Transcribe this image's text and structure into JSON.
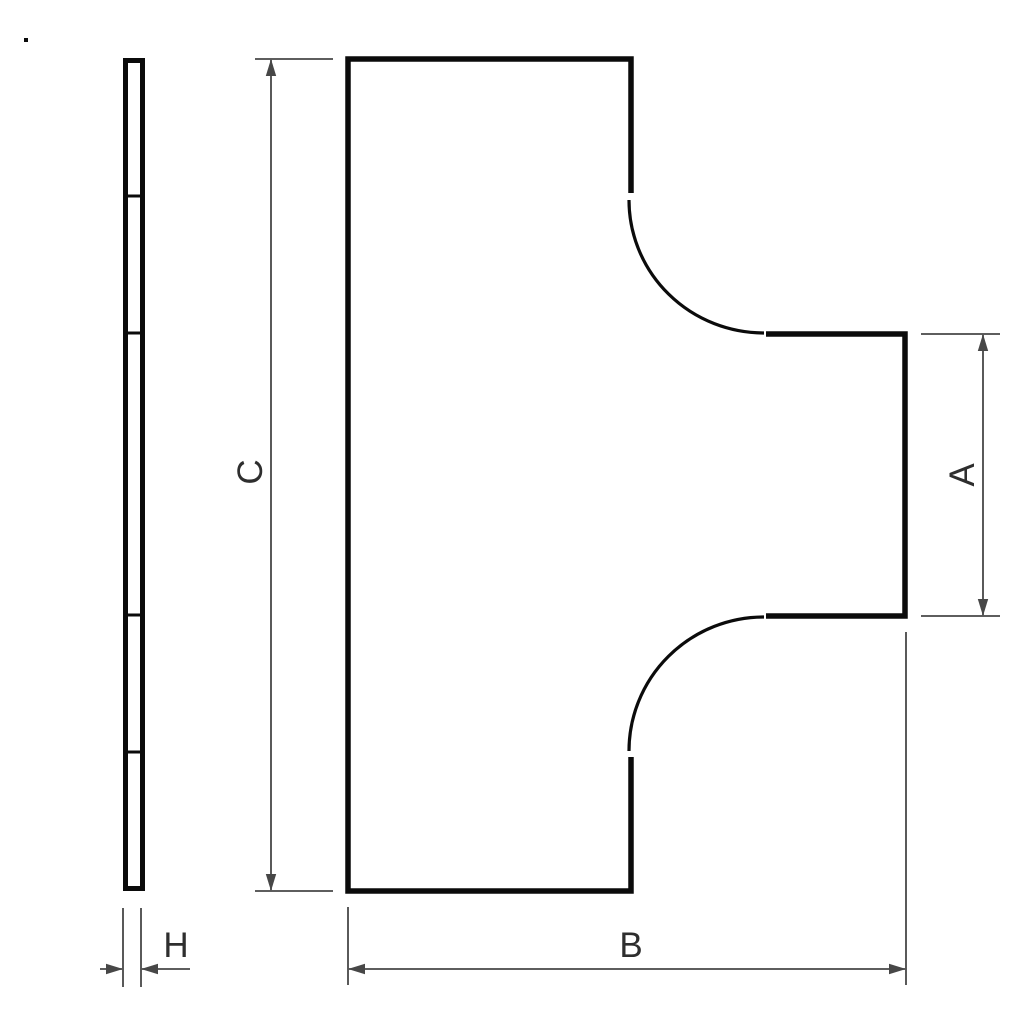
{
  "colors": {
    "background": "#ffffff",
    "outline": "#0b0b0b",
    "dimension": "#474747",
    "label": "#2e2e2e"
  },
  "drawing": {
    "labels": {
      "branch_width": "A",
      "overall_width": "B",
      "overall_height": "C",
      "thickness": "H"
    }
  }
}
